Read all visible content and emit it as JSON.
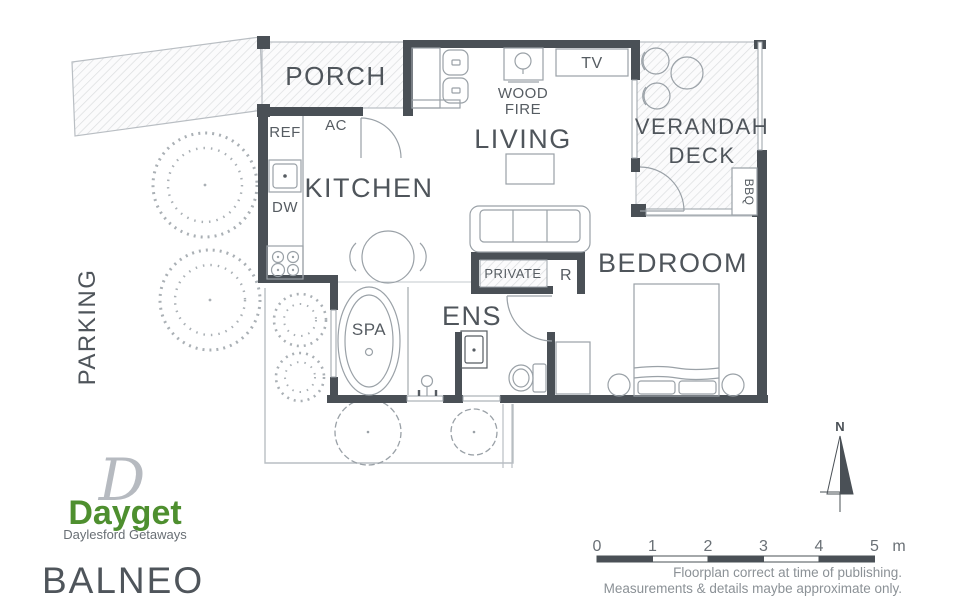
{
  "brand": {
    "monogram": "D",
    "name": "Dayget",
    "tagline": "Daylesford Getaways",
    "green": "#4e8f2f"
  },
  "title": "BALNEO",
  "rooms": {
    "porch": "PORCH",
    "kitchen": "KITCHEN",
    "living": "LIVING",
    "verandah_line1": "VERANDAH",
    "verandah_line2": "DECK",
    "bedroom": "BEDROOM",
    "ens": "ENS",
    "spa": "SPA",
    "parking": "PARKING"
  },
  "fixtures": {
    "ref": "REF",
    "ac": "AC",
    "dw": "DW",
    "wood_line1": "WOOD",
    "wood_line2": "FIRE",
    "tv": "TV",
    "private": "PRIVATE",
    "robe": "R",
    "bbq": "BBQ"
  },
  "compass": {
    "north": "N"
  },
  "scale_bar": {
    "ticks": [
      "0",
      "1",
      "2",
      "3",
      "4",
      "5"
    ],
    "unit": "m"
  },
  "footer": {
    "line1": "Floorplan correct at time of publishing.",
    "line2": "Measurements & details maybe approximate only."
  },
  "colors": {
    "wall": "#4a5056",
    "furniture_line": "#9aa1a7",
    "area_outline": "#b9bec3",
    "hatch": "#dcdee0",
    "label_text": "#4f555b",
    "muted_text": "#8b9196"
  }
}
